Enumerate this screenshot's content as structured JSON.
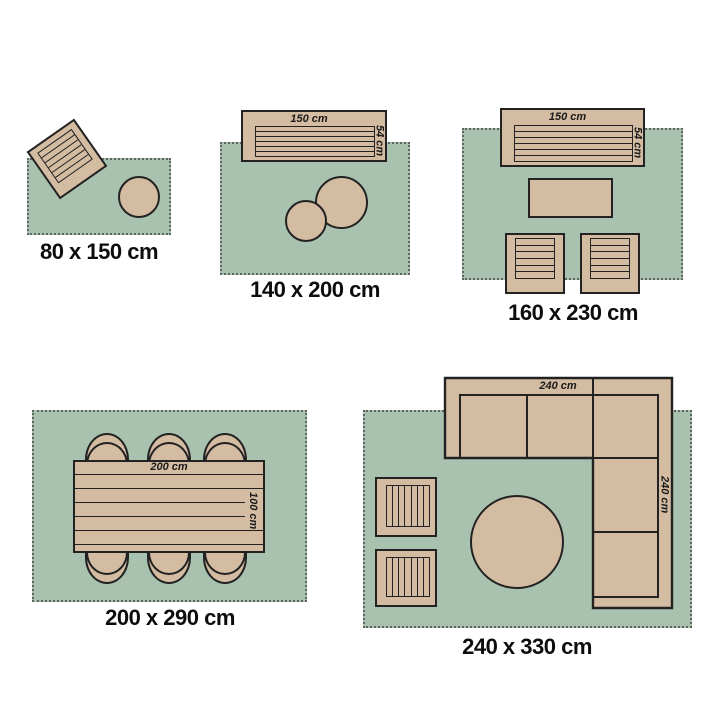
{
  "colors": {
    "rug": "#a9c2af",
    "furniture": "#d4bca2",
    "outline": "#222222",
    "fringe": "#5f645f",
    "label_text": "#0d0d0d"
  },
  "sections": [
    {
      "size_label": "80 x 150 cm",
      "furniture": [
        "rotated-armchair",
        "round-side-table"
      ]
    },
    {
      "size_label": "140 x 200 cm",
      "furniture": [
        "sofa",
        "round-table-large",
        "round-table-small"
      ],
      "sofa": {
        "width_label": "150 cm",
        "depth_label": "54 cm"
      }
    },
    {
      "size_label": "160 x 230 cm",
      "furniture": [
        "sofa",
        "coffee-table",
        "armchair-left",
        "armchair-right"
      ],
      "sofa": {
        "width_label": "150 cm",
        "depth_label": "54 cm"
      }
    },
    {
      "size_label": "200 x 290 cm",
      "furniture": [
        "dining-table",
        "six-dining-chairs"
      ],
      "dining_table": {
        "width_label": "200 cm",
        "depth_label": "100 cm"
      }
    },
    {
      "size_label": "240 x 330 cm",
      "furniture": [
        "corner-sofa",
        "round-table",
        "stool-top",
        "stool-bottom"
      ],
      "corner_sofa": {
        "width_label": "240 cm",
        "depth_label": "240 cm"
      }
    }
  ]
}
